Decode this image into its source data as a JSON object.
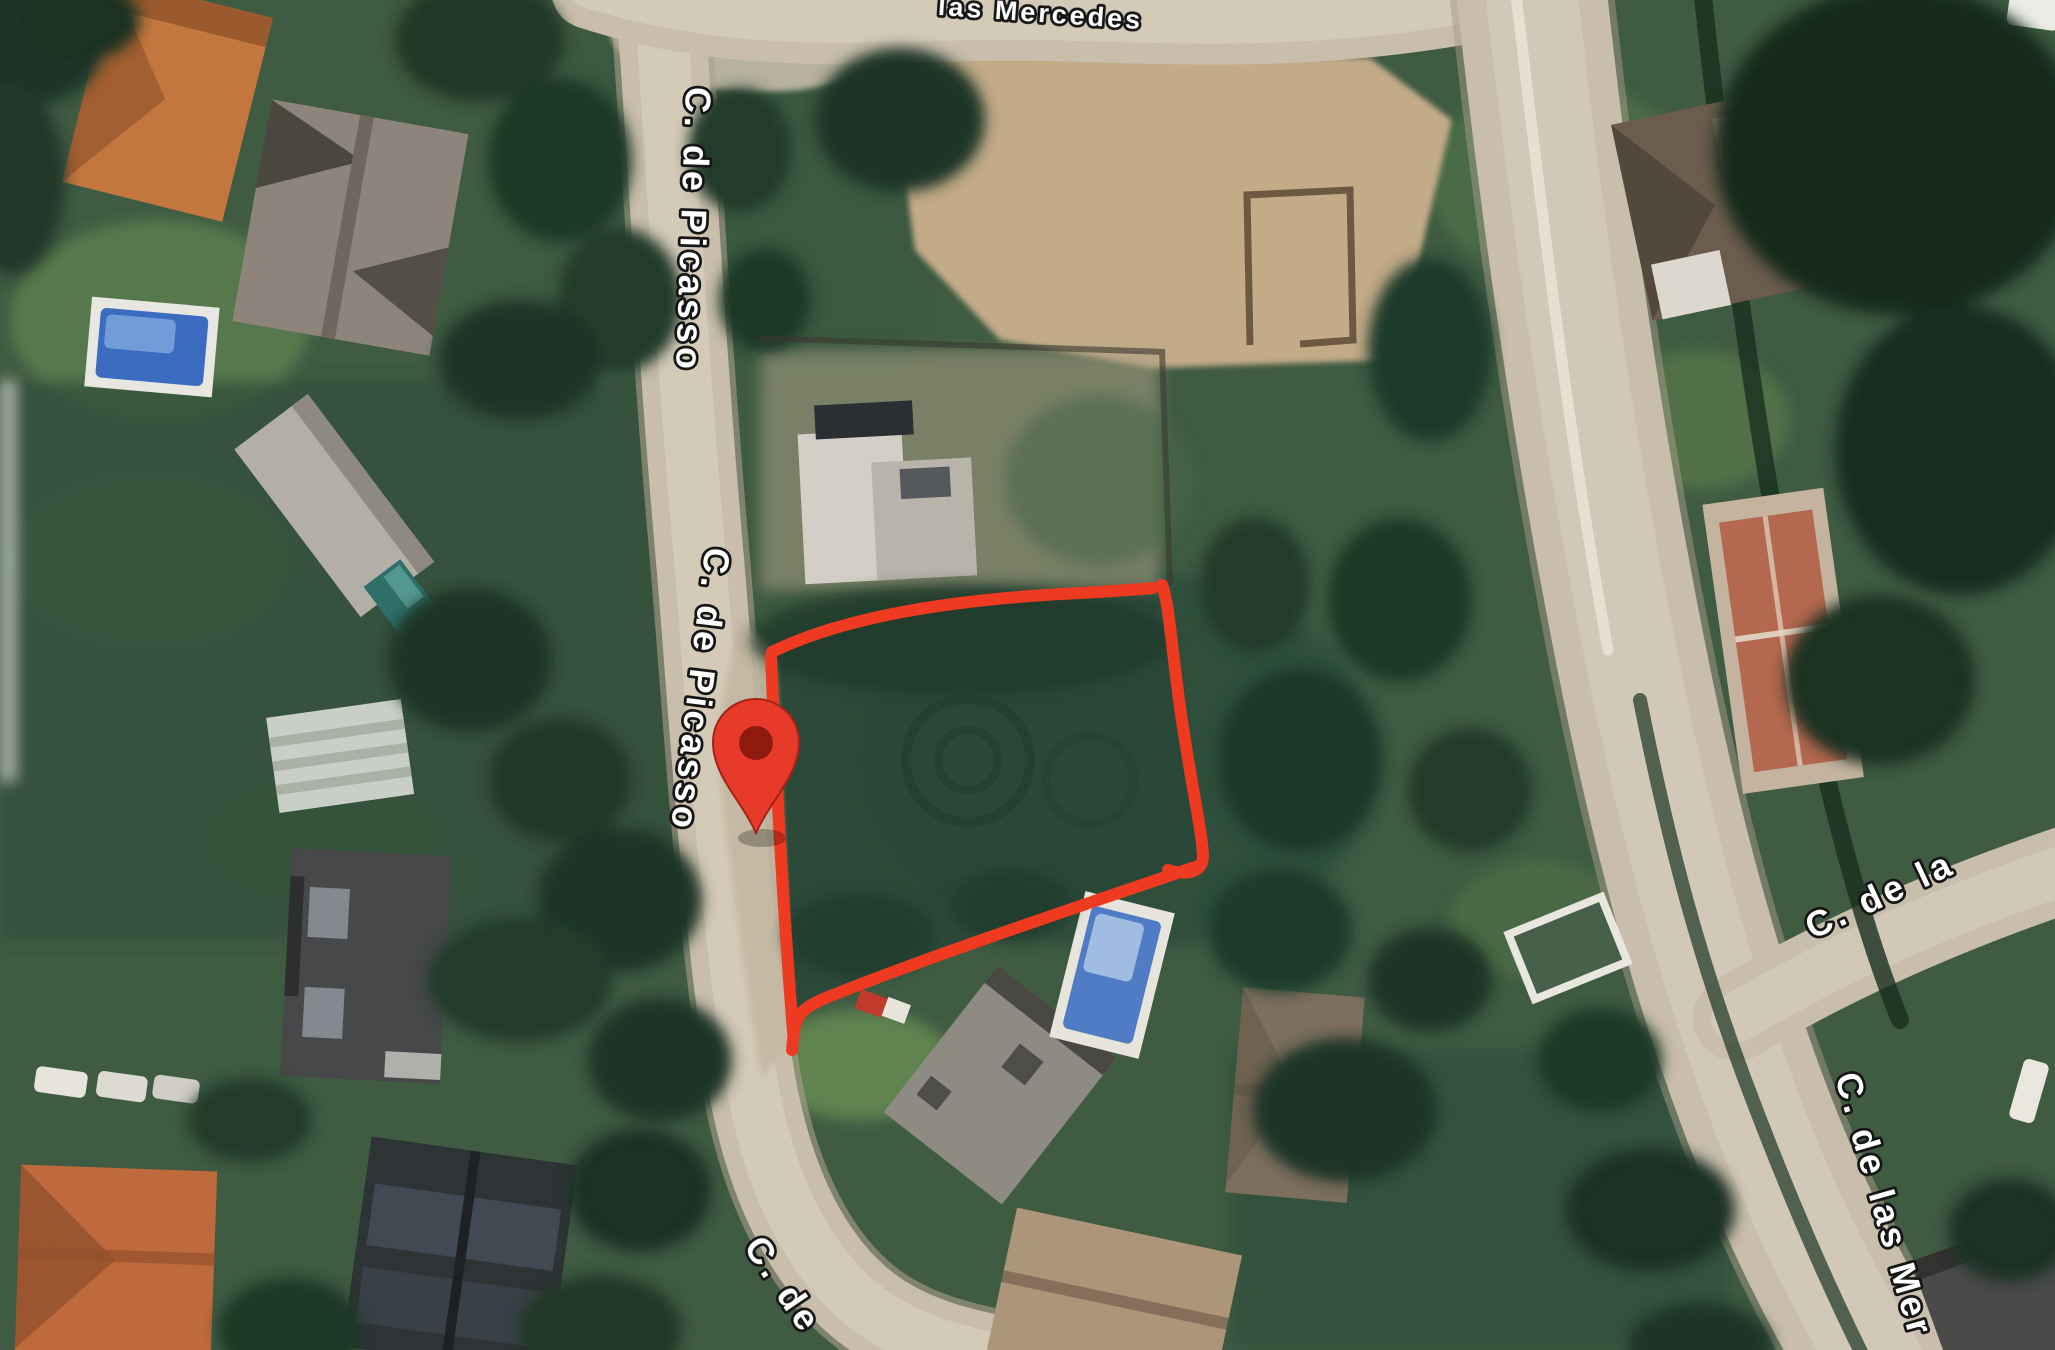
{
  "page": {
    "title": "Satellite map with outlined parcel and location pin"
  },
  "map": {
    "streets": {
      "top_partial": "las Mercedes",
      "picasso_upper": "C. de Picasso",
      "picasso_lower": "C. de Picasso",
      "picasso_bottom_partial": "C. de",
      "right_branch": "C. de la",
      "right_main_partial": "C. de las Mer"
    },
    "marker": {
      "kind": "location-pin",
      "color": "#e83a2a",
      "inner_color": "#8e1a10"
    },
    "parcel": {
      "outline_color": "#ee3a20"
    },
    "palette": {
      "road": "#c9beac",
      "road_center": "#d7cdbc",
      "road_edge": "#aca08d",
      "sand": "#c3ab88",
      "vegetation_base": "#3f5b42",
      "vegetation_dark": "#1f3827",
      "lawn": "#64874f",
      "pool_blue": "#4f7cc4",
      "label_fill": "#ffffff",
      "label_outline": "#161616"
    }
  }
}
